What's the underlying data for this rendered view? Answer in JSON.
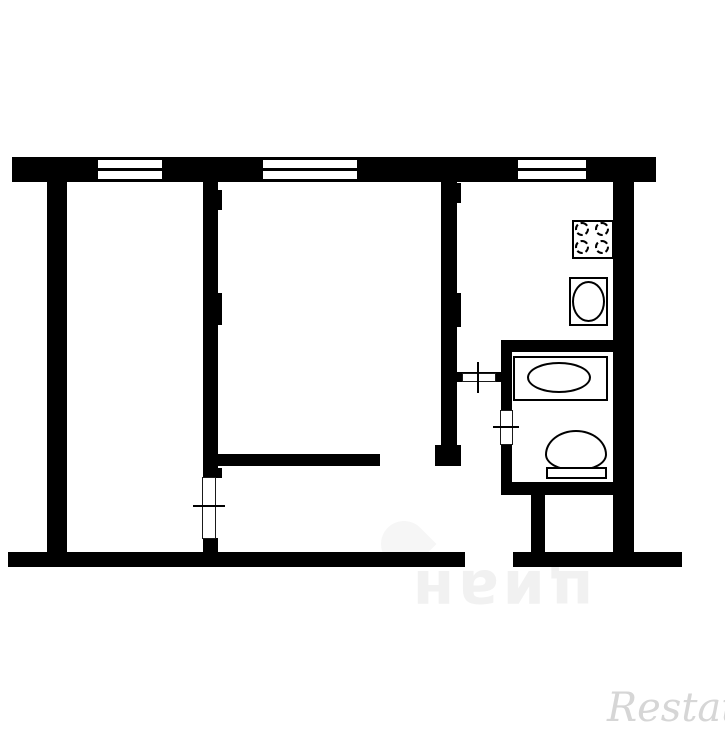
{
  "canvas": {
    "width": 725,
    "height": 725,
    "bg": "#ffffff",
    "wall_color": "#000000"
  },
  "watermarks": {
    "center": {
      "text": "циан",
      "color": "#f1f1f1"
    },
    "brand": {
      "text": "Restate",
      "color": "#d6d6d6"
    }
  },
  "floorplan": {
    "primitives": [
      {
        "type": "wall",
        "name": "top-wall",
        "x": 12,
        "y": 157,
        "w": 644,
        "h": 25
      },
      {
        "type": "wall",
        "name": "left-wall",
        "x": 47,
        "y": 182,
        "w": 20,
        "h": 370
      },
      {
        "type": "wall",
        "name": "right-wall",
        "x": 613,
        "y": 182,
        "w": 21,
        "h": 370
      },
      {
        "type": "wall",
        "name": "bottom-wall-left",
        "x": 8,
        "y": 552,
        "w": 457,
        "h": 15
      },
      {
        "type": "wall",
        "name": "bottom-wall-right",
        "x": 513,
        "y": 552,
        "w": 169,
        "h": 15
      },
      {
        "type": "wall",
        "name": "room-partition-upper",
        "x": 203,
        "y": 182,
        "w": 15,
        "h": 296
      },
      {
        "type": "wall",
        "name": "room-partition-lower",
        "x": 203,
        "y": 538,
        "w": 15,
        "h": 14
      },
      {
        "type": "wall",
        "name": "kitchen-partition",
        "x": 441,
        "y": 182,
        "w": 16,
        "h": 263
      },
      {
        "type": "wall",
        "name": "kitchen-partition-cap",
        "x": 435,
        "y": 445,
        "w": 26,
        "h": 21
      },
      {
        "type": "wall",
        "name": "hallway-wall",
        "x": 218,
        "y": 454,
        "w": 162,
        "h": 12
      },
      {
        "type": "wall",
        "name": "kitchen-door-wall",
        "x": 455,
        "y": 372,
        "w": 47,
        "h": 10
      },
      {
        "type": "wall",
        "name": "bathroom-top-wall",
        "x": 501,
        "y": 340,
        "w": 112,
        "h": 12
      },
      {
        "type": "wall",
        "name": "bathroom-left-wall-upper",
        "x": 501,
        "y": 340,
        "w": 11,
        "h": 71
      },
      {
        "type": "wall",
        "name": "bathroom-left-wall-lower",
        "x": 501,
        "y": 444,
        "w": 11,
        "h": 39
      },
      {
        "type": "wall",
        "name": "bathroom-bottom-wall",
        "x": 501,
        "y": 482,
        "w": 112,
        "h": 13
      },
      {
        "type": "wall",
        "name": "closet-wall",
        "x": 531,
        "y": 495,
        "w": 14,
        "h": 57
      },
      {
        "type": "wall",
        "name": "wall-bump",
        "x": 218,
        "y": 190,
        "w": 4,
        "h": 20
      },
      {
        "type": "wall",
        "name": "wall-bump",
        "x": 218,
        "y": 293,
        "w": 4,
        "h": 32
      },
      {
        "type": "wall",
        "name": "wall-bump",
        "x": 218,
        "y": 468,
        "w": 4,
        "h": 10
      },
      {
        "type": "wall",
        "name": "wall-bump",
        "x": 457,
        "y": 183,
        "w": 4,
        "h": 20
      },
      {
        "type": "wall",
        "name": "wall-bump",
        "x": 457,
        "y": 293,
        "w": 4,
        "h": 34
      },
      {
        "type": "white",
        "name": "window-pane",
        "x": 98,
        "y": 160,
        "w": 64,
        "h": 19
      },
      {
        "type": "line",
        "name": "window-mullion",
        "x": 98,
        "y": 168,
        "w": 64,
        "h": 3
      },
      {
        "type": "white",
        "name": "window-pane",
        "x": 263,
        "y": 160,
        "w": 94,
        "h": 19
      },
      {
        "type": "line",
        "name": "window-mullion",
        "x": 263,
        "y": 168,
        "w": 94,
        "h": 3
      },
      {
        "type": "white",
        "name": "window-pane",
        "x": 518,
        "y": 160,
        "w": 68,
        "h": 19
      },
      {
        "type": "line",
        "name": "window-mullion",
        "x": 518,
        "y": 168,
        "w": 68,
        "h": 3
      },
      {
        "type": "box-thin",
        "name": "room1-door-leaf",
        "x": 202,
        "y": 477,
        "w": 14,
        "h": 62
      },
      {
        "type": "line",
        "name": "room1-door-tick",
        "x": 193,
        "y": 505,
        "w": 32,
        "h": 2
      },
      {
        "type": "box-thin",
        "name": "kitchen-door-leaf",
        "x": 462,
        "y": 373,
        "w": 34,
        "h": 9
      },
      {
        "type": "line",
        "name": "kitchen-door-tick",
        "x": 477,
        "y": 362,
        "w": 2,
        "h": 31
      },
      {
        "type": "box-thin",
        "name": "bathroom-door-leaf",
        "x": 500,
        "y": 410,
        "w": 13,
        "h": 35
      },
      {
        "type": "line",
        "name": "bathroom-door-tick",
        "x": 493,
        "y": 426,
        "w": 26,
        "h": 2
      },
      {
        "type": "box",
        "name": "stove",
        "x": 572,
        "y": 220,
        "w": 42,
        "h": 39
      },
      {
        "type": "dashed",
        "name": "stove-burner",
        "x": 575,
        "y": 222,
        "w": 14,
        "h": 14
      },
      {
        "type": "dashed",
        "name": "stove-burner",
        "x": 595,
        "y": 222,
        "w": 14,
        "h": 14
      },
      {
        "type": "dashed",
        "name": "stove-burner",
        "x": 575,
        "y": 240,
        "w": 14,
        "h": 14
      },
      {
        "type": "dashed",
        "name": "stove-burner",
        "x": 595,
        "y": 240,
        "w": 14,
        "h": 14
      },
      {
        "type": "box",
        "name": "kitchen-sink",
        "x": 569,
        "y": 277,
        "w": 39,
        "h": 49
      },
      {
        "type": "ellipse",
        "name": "kitchen-sink-basin",
        "x": 572,
        "y": 281,
        "w": 33,
        "h": 41
      },
      {
        "type": "box",
        "name": "bathtub",
        "x": 513,
        "y": 356,
        "w": 95,
        "h": 45
      },
      {
        "type": "ellipse",
        "name": "bathtub-basin",
        "x": 527,
        "y": 362,
        "w": 64,
        "h": 31
      },
      {
        "type": "bowl",
        "name": "toilet-bowl",
        "x": 545,
        "y": 430,
        "w": 62,
        "h": 41
      },
      {
        "type": "box",
        "name": "toilet-tank",
        "x": 546,
        "y": 467,
        "w": 61,
        "h": 12
      }
    ]
  }
}
